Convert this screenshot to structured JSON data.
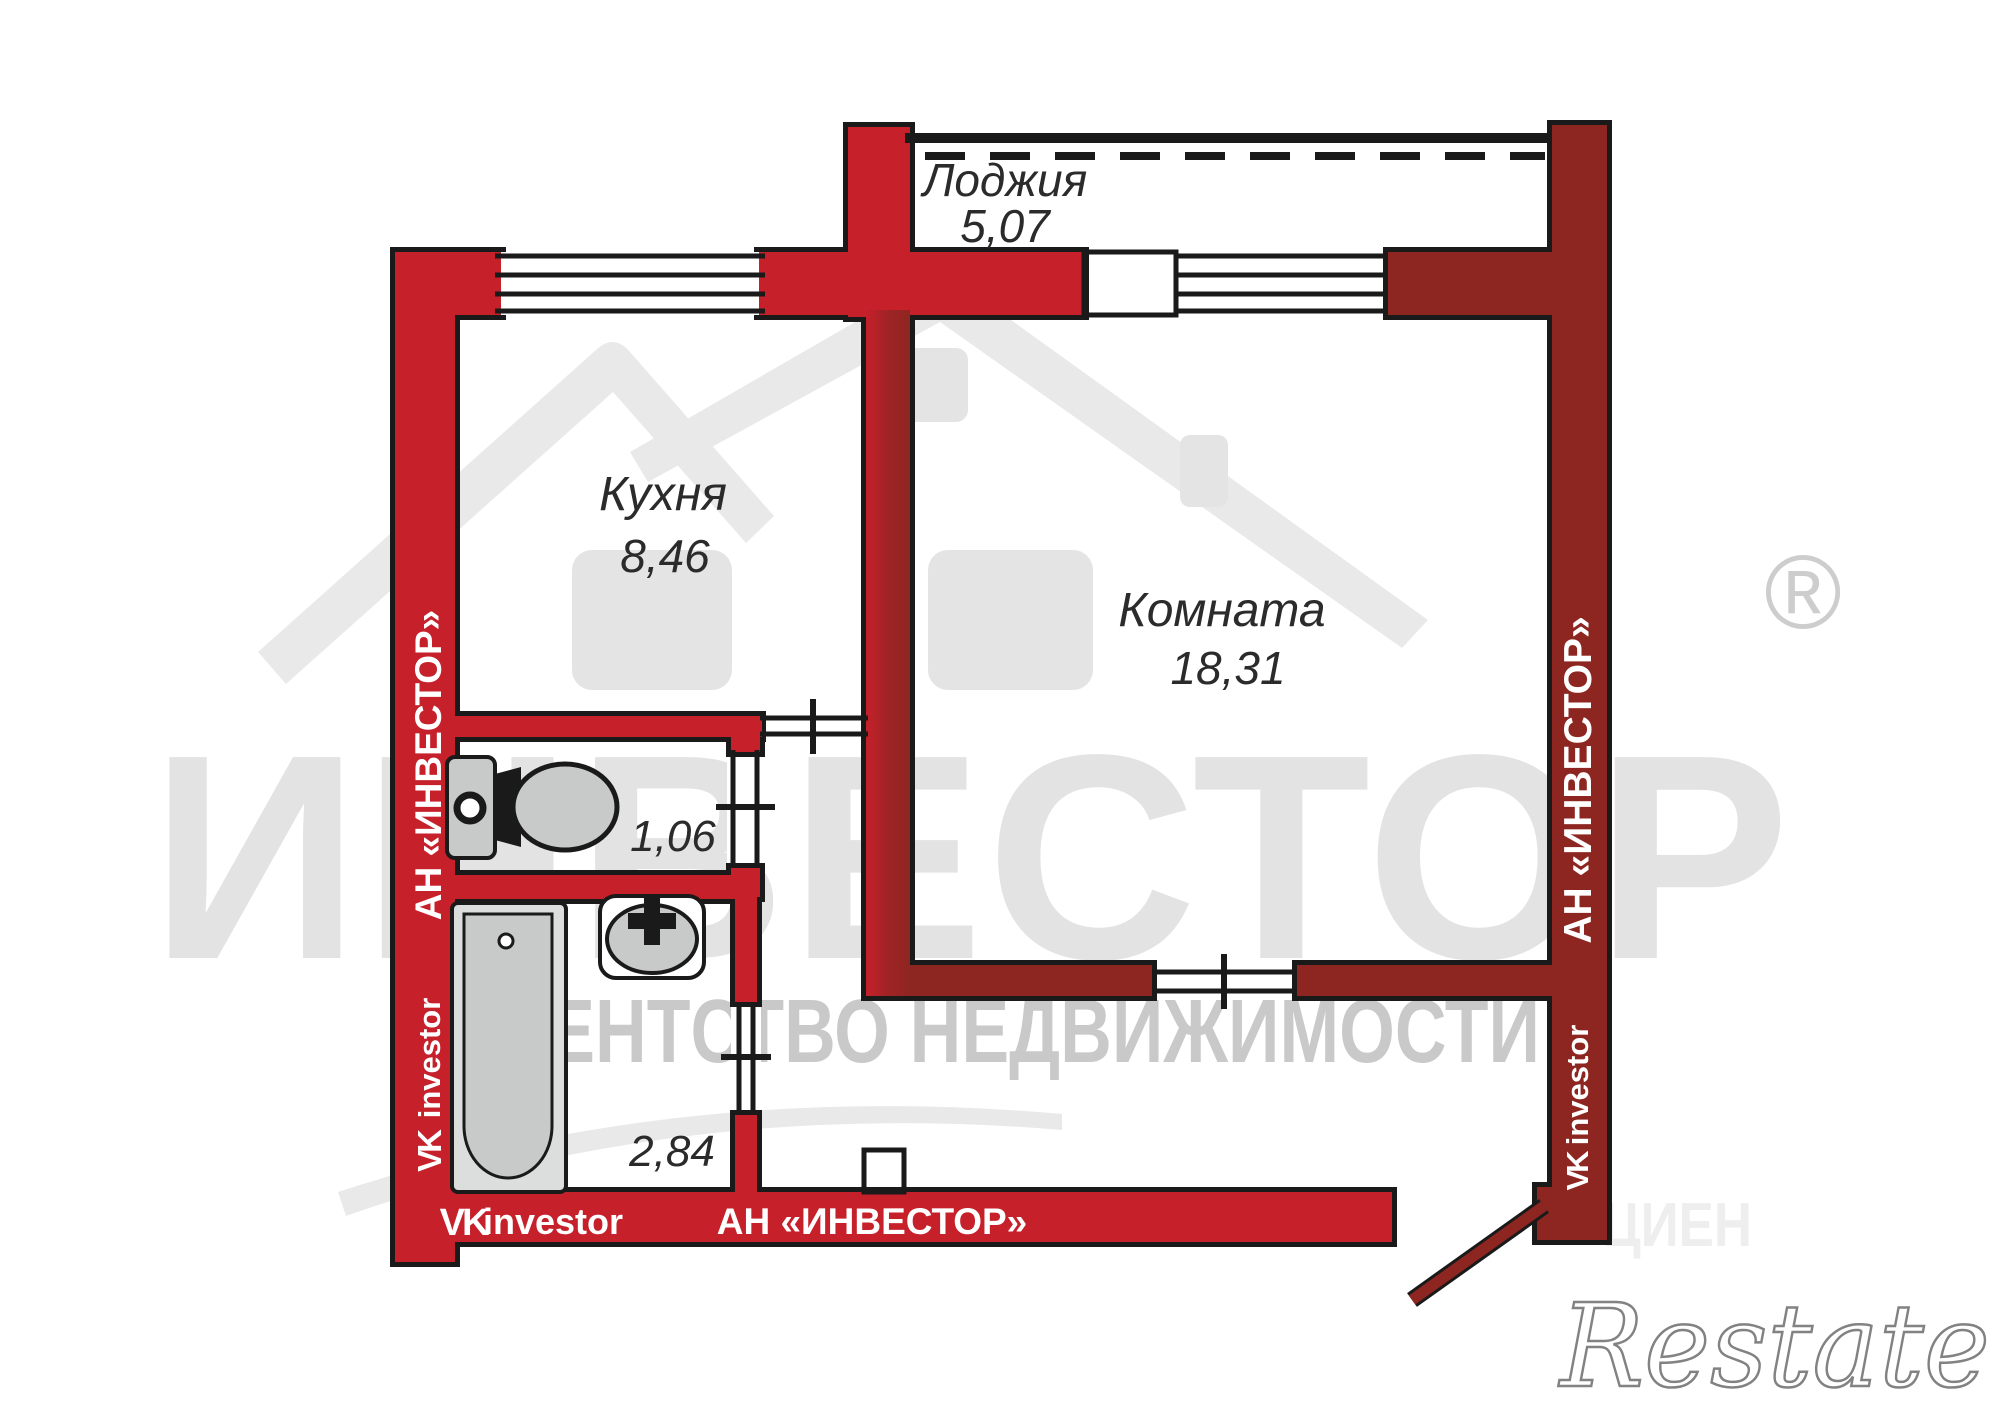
{
  "plan": {
    "rooms": {
      "balcony": {
        "label": "Лоджия",
        "area": "5,07"
      },
      "kitchen": {
        "label": "Кухня",
        "area": "8,46"
      },
      "living_room": {
        "label": "Комната",
        "area": "18,31"
      },
      "wc": {
        "area": "1,06"
      },
      "bathroom": {
        "area": "2,84"
      }
    }
  },
  "branding": {
    "agency_full": "АН «ИНВЕСТОР»",
    "vk_glyph": "VK",
    "vk_handle": "investor",
    "watermark_title": "ИНВЕСТОР",
    "watermark_registered": "®",
    "watermark_subtitle": "АГЕНТСТВО НЕДВИЖИМОСТИ",
    "portal_logo": "Restate",
    "faint_watermark": "ЦИЕН"
  },
  "colors": {
    "wall-red": "#c6202a",
    "wall-dark": "#8d2621",
    "outline": "#1a1a1a",
    "fixture-gray": "#c7cac9",
    "fixture-light": "#dcdedd",
    "label-ink": "#2b2b2b",
    "wm-light": "#e3e3e3",
    "wm-mid": "#c9c9c9",
    "wall-text": "#ffffff"
  }
}
